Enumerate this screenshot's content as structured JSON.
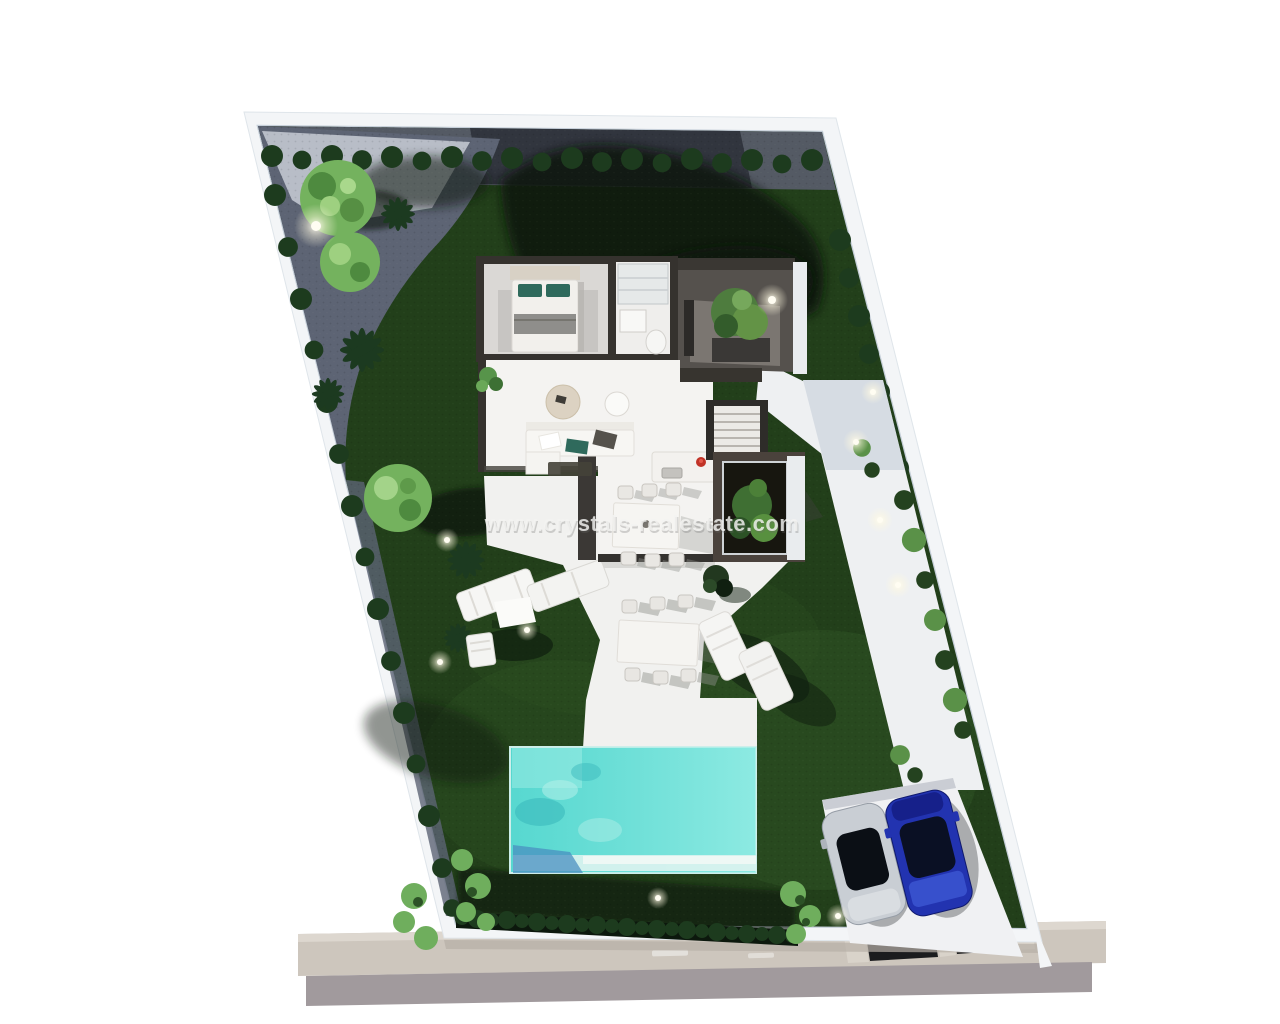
{
  "watermark": {
    "text": "www.crystals-realestate.com",
    "color": "#f4f4f2"
  },
  "scene": {
    "type": "aerial-3d-render",
    "subject": "villa-plot-site-plan",
    "house_rooms": [
      "bedroom",
      "bathroom",
      "entrance-courtyard",
      "living-room",
      "kitchen",
      "dining-area",
      "staircase",
      "interior-patio"
    ],
    "garden_elements": [
      "lawn",
      "perimeter-bushes",
      "round-trees",
      "palm-plants",
      "garden-lights",
      "gravel-path",
      "paved-patio",
      "bottom-hedge"
    ],
    "amenities": [
      "swimming-pool",
      "terrace",
      "sun-loungers",
      "outdoor-dining-set",
      "walkway"
    ],
    "parking": {
      "cars": [
        {
          "name": "car-silver",
          "hex": "#c9ced4"
        },
        {
          "name": "car-blue",
          "hex": "#2233b0"
        }
      ]
    }
  },
  "colors": {
    "bg": "#ffffff",
    "wall": "#f3f5f7",
    "wallShade": "#c6cfd9",
    "sidewalk": "#cdc6bd",
    "sidewalkLight": "#ddd7cf",
    "street": "#a19a9d",
    "crossingDark": "#1b1c1e",
    "gravel": "#545a64",
    "paving": "#5d6474",
    "pavingLight": "#c8cdd6",
    "grass": "#223f1a",
    "grassLight": "#2e5424",
    "grassShadow": "#0b160c",
    "bush": "#1d3b1e",
    "treeLight": "#74b25e",
    "plantLight": "#6fae5d",
    "palm": "#1c3a20",
    "terrace": "#f1f1ef",
    "walkway": "#eef0f2",
    "houseFloor": "#f4f3f1",
    "houseFloorGray": "#dad8d5",
    "houseWall": "#35322e",
    "courtyard": "#55514d",
    "bedTeal": "#2f6a5c",
    "kitchenRed": "#c13327",
    "pool": "#57d8d0",
    "poolStep": "#ddf3ef",
    "poolShadow": "#4a8fc0",
    "driveway": "#f0f1f3",
    "carSilver": "#c9ced4",
    "carBlue": "#2233b0",
    "carGlass": "#0b0f15"
  }
}
